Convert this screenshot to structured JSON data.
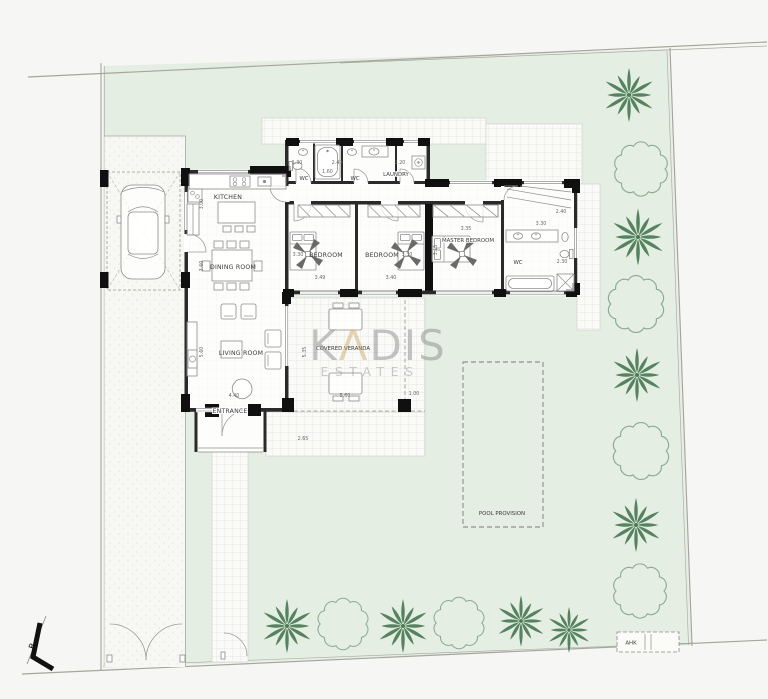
{
  "watermark": {
    "k": "K",
    "a": "Λ",
    "dis": "DIS",
    "estates": "ESTATES"
  },
  "rooms": {
    "kitchen": "KITCHEN",
    "dining": "DINING ROOM",
    "living": "LIVING ROOM",
    "entrance": "ENTRANCE",
    "wc": "WC",
    "laundry": "LAUNDRY",
    "bedroom": "BEDROOM",
    "master": "MASTER BEDROOM",
    "veranda": "COVERED VERANDA",
    "pool": "POOL PROVISION"
  },
  "annotations": {
    "ahk": "AHK",
    "section_marker": "B"
  },
  "dims": {
    "top_wc": "1.30",
    "top_bath": "1.60",
    "top_wc2": "2.40",
    "top_laundry": "2.20",
    "kitchen": "3.00",
    "dining": "3.60",
    "living_len": "5.60",
    "living_w": "4.40",
    "bed1_d": "3.30",
    "bed1_w": "3.49",
    "bed2_d": "3.30",
    "bed2_w": "3.40",
    "master_w": "3.35",
    "master_d": "3.15",
    "wc3_top": "3.30",
    "wc3_e": "2.40",
    "wc3_s": "2.30",
    "ver_d": "5.35",
    "ver_w": "5.60",
    "ver_open": "1.00",
    "walk": "2.65"
  },
  "colors": {
    "background": "#f6f6f4",
    "plot_green": "#e5eee2",
    "wall": "#1b1b1b",
    "palm_green": "#4a7a54",
    "bush_green": "#8aab90",
    "watermark_gray": "#909090",
    "watermark_gold": "#c9a55f",
    "dimension_text": "#666666",
    "label_text": "#3a3a3a"
  }
}
